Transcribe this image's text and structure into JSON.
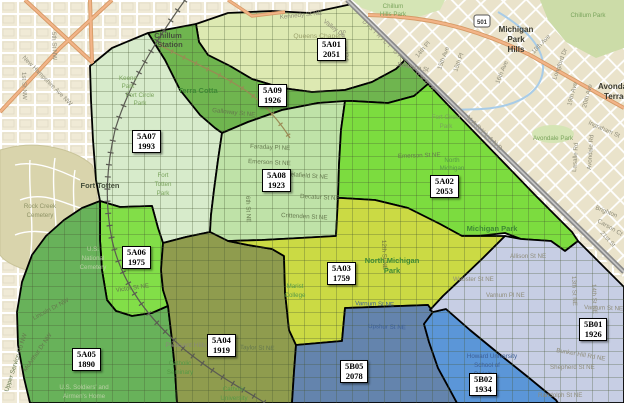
{
  "region_colors": {
    "r5A01": "#dde9b2",
    "r5A02": "#7cdc3f",
    "r5A03": "#cbda44",
    "r5A04": "#8f9c4e",
    "r5A05": "#68b25a",
    "r5A06": "#82de48",
    "r5A07": "#d7ebcb",
    "r5A08": "#bfe2a8",
    "r5A09": "#6fb54f",
    "r5B01": "#c7cee4",
    "r5B02": "#5b96d8",
    "r5B05": "#6484ad"
  },
  "psa_labels": [
    {
      "code": "5A01",
      "value": "2051"
    },
    {
      "code": "5A02",
      "value": "2053"
    },
    {
      "code": "5A03",
      "value": "1759"
    },
    {
      "code": "5A04",
      "value": "1919"
    },
    {
      "code": "5A05",
      "value": "1890"
    },
    {
      "code": "5A06",
      "value": "1975"
    },
    {
      "code": "5A07",
      "value": "1993"
    },
    {
      "code": "5A08",
      "value": "1923"
    },
    {
      "code": "5A09",
      "value": "1926"
    },
    {
      "code": "5B01",
      "value": "1926"
    },
    {
      "code": "5B02",
      "value": "1934"
    },
    {
      "code": "5B05",
      "value": "2078"
    }
  ],
  "boundary": {
    "dc": "DISTRICT OF COLUMBIA",
    "md": "MARYLAND"
  },
  "route_shield": "501",
  "places": {
    "chillum_station": [
      "Chillum",
      "Station"
    ],
    "terra_cotta": "Terra Cotta",
    "queens_chapel": "Queens Chapel",
    "fort_totten": "Fort Totten",
    "pleasant_hills": "Pleasant Hills",
    "michigan_park": "Michigan Park",
    "north_michigan_park": [
      "North Michigan",
      "Park"
    ],
    "north_michigan_small": [
      "North",
      "Michigan"
    ],
    "michigan_park_hills": [
      "Michigan",
      "Park",
      "Hills"
    ],
    "avondale_terrace": [
      "Avondale",
      "Terrace"
    ],
    "howard_university": [
      "Howard University",
      "School of",
      "Divinity"
    ],
    "catholic_university": [
      "Catholic",
      "University"
    ],
    "catholic_seminary": [
      "Catholic",
      "Seminary"
    ],
    "marist_college": [
      "Marist",
      "College"
    ]
  },
  "parks": {
    "chillum_hills_park": [
      "Chillum",
      "Hills Park"
    ],
    "chillum_park": "Chillum Park",
    "avondale_park": "Avondale Park",
    "keene_park": [
      "Keene",
      "Park"
    ],
    "fort_circle_park": [
      "Fort Circle",
      "Park"
    ],
    "fort_totten_park": [
      "Fort",
      "Totten",
      "Park"
    ],
    "rock_creek_cemetery": [
      "Rock Creek",
      "Cemetery"
    ],
    "us_national_cemetery": [
      "U.S.",
      "National",
      "Cemetery"
    ],
    "soldiers_home": [
      "U.S. Soldiers' and",
      "Airmen's Home"
    ]
  },
  "streets": {
    "valley_dr": "Valley Dr",
    "sargent_rd": "Sargent Rd",
    "pl14": "14th Pl",
    "jefferson_st": "Jefferson St",
    "ave15": "15th Ave",
    "pl15": "15th Pl",
    "ave16": "16th Ave",
    "ave18": "18th Ave",
    "longford_dr": "Longford Dr",
    "ave19": "19th Ave",
    "ave20": "20th Ave",
    "ingraham_st": "Ingraham St",
    "lasalle_rd": "Lasalle Rd",
    "avondale_rd": "Avondale Rd",
    "brighton": "Brighton",
    "carson_ct": "Carson Ct",
    "st21": "21st St",
    "kennedy_st": "Kennedy St NE",
    "galloway_st": "Galloway St NE",
    "faraday_pl": "Faraday Pl NE",
    "emerson_st": "Emerson St NE",
    "delafield_st": "Delafield St NE",
    "decatur_st": "Decatur St NE",
    "crittenden_st": "Crittenden St NE",
    "victor_st": "Victor St NE",
    "lincoln_dr": "Lincoln Dr NW",
    "upper_service_rd": "Upper Service Rd NW",
    "mcarthur_dr": "McArthur Dr NW",
    "taylor_st": "Taylor St NE",
    "varnum_st": "Varnum St NE",
    "upshur_st": "Upshur St NE",
    "webster_st": "Webster St NE",
    "allison_st": "Allison St NE",
    "varnum_pl": "Varnum Pl NE",
    "st13": "13th St NE",
    "st14": "14th St NE",
    "st12": "12th St NE",
    "st6": "6th St NE",
    "bunker_hill_rd": "Bunker Hill Rd NE",
    "shepherd_st": "Shepherd St NE",
    "randolph_st": "Randolph St NE",
    "new_hampshire_ave": "New Hampshire Ave NW",
    "st5nw": "5th St NW",
    "st1nw": "1st St NW"
  }
}
